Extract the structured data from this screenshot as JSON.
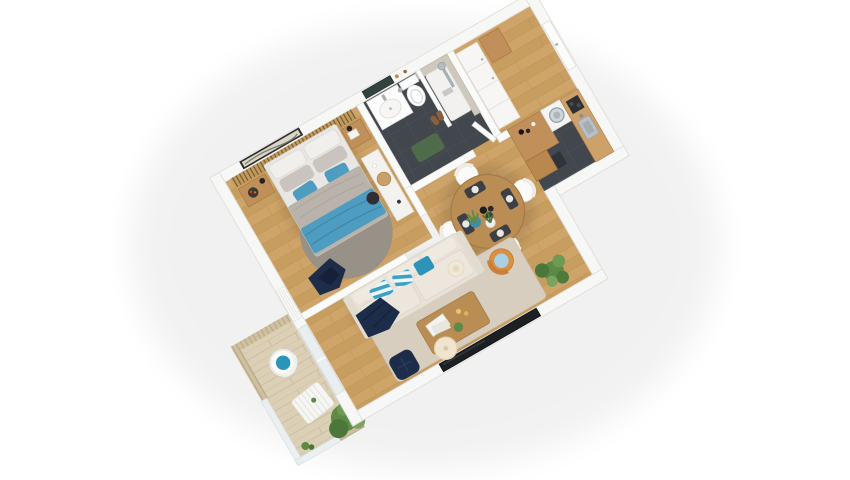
{
  "meta": {
    "title": "3D isometric floor plan render of a one-bedroom apartment with balcony",
    "view": "axonometric top-down, rotated ~30 degrees, white background",
    "background": "#ffffff"
  },
  "palette": {
    "background": "#ffffff",
    "wall": "#f7f7f6",
    "wall_edge": "#e1e0de",
    "wood_floor": "#cfa469",
    "wood_floor_alt": "#c89d60",
    "wood_line": "#b88c51",
    "tile_dark": "#42474d",
    "tile_line": "#50565d",
    "deck": "#dbcfb5",
    "deck_line": "#c8ba9c",
    "slat_wood": "#c49a58",
    "slat_dark": "#3a342c",
    "screen_wood": "#cfc09f",
    "screen_line": "#b2a183",
    "rug_living": "#d8cec0",
    "rug_bedroom": "#95908a",
    "mattress": "#e9e7e3",
    "pillow": "#f1efeb",
    "pillow_gray": "#c9c5be",
    "duvet": "#b9b3ab",
    "bed_blue": "#4e9cc0",
    "accent_teal": "#2c94b8",
    "stripe_blue": "#3d9fc4",
    "navy": "#1d2c49",
    "sofa": "#e7e1d7",
    "sofa_cushion": "#ece6dc",
    "wood_furniture": "#c1905a",
    "wood_table": "#b98d54",
    "plant": "#5d8a47",
    "plant_dark": "#4c773a",
    "shower_tile": "#cfc8bd",
    "fixture_white": "#fdfdfd",
    "fixture_edge": "#e0e0de",
    "glass": "#e8eef0",
    "mirror": "#32423e",
    "frame_dark": "#2f2e2a",
    "metal": "#a9b0b5",
    "mat_green": "#4e6b4a",
    "tv_black": "#1d2023"
  },
  "rooms": [
    {
      "id": "bedroom",
      "name": "bedroom",
      "floor": "wood planks",
      "items": [
        "double-bed with gray duvet and blue throw",
        "white and gray pillows",
        "blue accent pillows",
        "wood slat headboard wall",
        "framed landscape artwork",
        "floating nightstand left with lamp and tray",
        "floating nightstand right with lamp",
        "white sideboard dresser with round tray",
        "dark stool",
        "round gray rug",
        "navy clothes on chair",
        "radiator on left wall"
      ]
    },
    {
      "id": "bathroom",
      "name": "bathroom",
      "floor": "dark slate tile",
      "items": [
        "white vanity with basin",
        "dark wall mirror",
        "toiletry shelf",
        "toilet",
        "walk-in shower with beige tile wall",
        "chrome shower column",
        "white shower tray",
        "green bath mat",
        "slippers"
      ]
    },
    {
      "id": "hall",
      "name": "entry hall",
      "floor": "wood planks",
      "items": [
        "white closet cabinets",
        "corner wood cabinet",
        "entrance door on right wall",
        "open bathroom door"
      ]
    },
    {
      "id": "kitchen",
      "name": "kitchen",
      "floor": "dark slate tile",
      "items": [
        "tall wood cabinet block with bottles",
        "washing machine",
        "wood counter along right wall",
        "steel sink with faucet",
        "dark hob",
        "floor mat"
      ]
    },
    {
      "id": "dining",
      "name": "dining area",
      "floor": "wood planks",
      "items": [
        "round wood table",
        "four white chairs",
        "wine bottles centerpiece",
        "four dark placemats with white plates"
      ]
    },
    {
      "id": "living",
      "name": "living room",
      "floor": "wood planks",
      "items": [
        "cream three-seat sofa",
        "blue-white striped pillows",
        "teal pillow",
        "navy throw blanket",
        "straw hat",
        "beige area rug",
        "wood coffee table with books, candles and plant",
        "navy pouf",
        "cream round side lamp",
        "rattan armchair with light blue pillow",
        "snake plants in pots",
        "monstera plant",
        "wall-mounted TV on bottom wall",
        "sliding glass balcony door"
      ]
    },
    {
      "id": "balcony",
      "name": "balcony",
      "floor": "light wood decking",
      "items": [
        "wood slat privacy screen",
        "glass railing",
        "white wire chair with teal cushion",
        "white slatted bench table",
        "wicker planter with green bush",
        "small plant sprig"
      ]
    }
  ]
}
